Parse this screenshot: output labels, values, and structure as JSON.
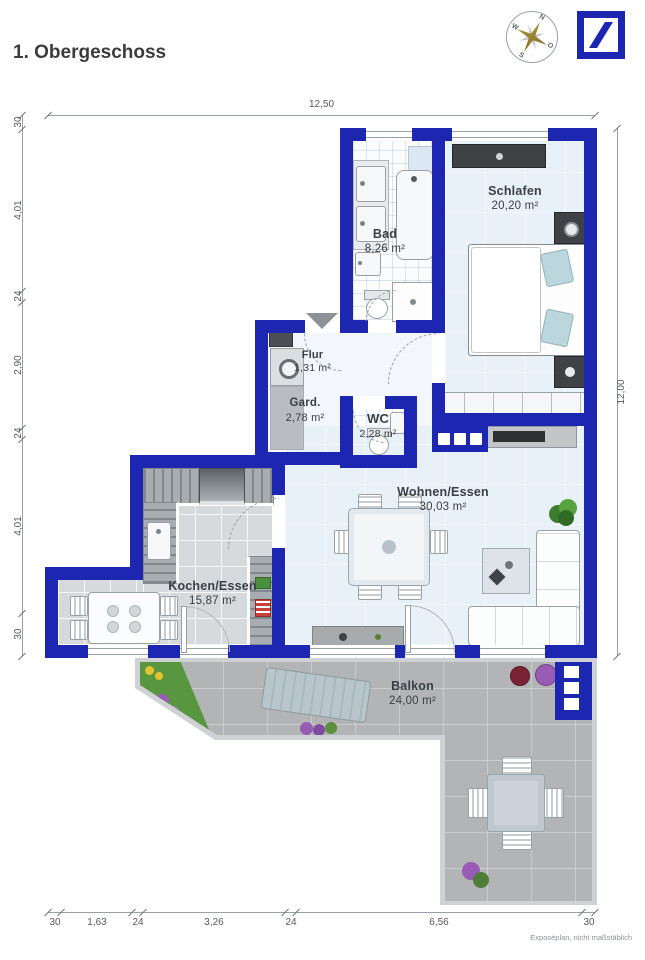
{
  "header": {
    "title": "1. Obergeschoss"
  },
  "compass": {
    "north": "N",
    "east": "O",
    "south": "S",
    "west": "W"
  },
  "plan": {
    "rooms": [
      {
        "id": "schlafen",
        "name": "Schlafen",
        "area": "20,20 m²"
      },
      {
        "id": "bad",
        "name": "Bad",
        "area": "8,26 m²"
      },
      {
        "id": "flur",
        "name": "Flur",
        "area": "1,31 m²"
      },
      {
        "id": "gard",
        "name": "Gard.",
        "area": "2,78 m²"
      },
      {
        "id": "wc",
        "name": "WC",
        "area": "2,28 m²"
      },
      {
        "id": "wohnen",
        "name": "Wohnen/Essen",
        "area": "30,03 m²"
      },
      {
        "id": "kochen",
        "name": "Kochen/Essen",
        "area": "15,87 m²"
      },
      {
        "id": "balkon",
        "name": "Balkon",
        "area": "24,00 m²"
      }
    ]
  },
  "dimensions": {
    "top_total": "12,50",
    "right_total": "12,00",
    "left_chain": [
      "30",
      "4,01",
      "24",
      "2,90",
      "24",
      "4,01",
      "30"
    ],
    "bottom_chain": [
      "30",
      "1,63",
      "24",
      "3,26",
      "24",
      "6,56",
      "30"
    ]
  },
  "footer": {
    "note": "Exposéplan, nicht maßstäblich"
  },
  "watermark": "IllustrationCommoGrafik",
  "colors": {
    "wall_blue": "#1c26b0",
    "floor_light": "#e9f1f8",
    "logo_blue": "#1c26b0"
  }
}
